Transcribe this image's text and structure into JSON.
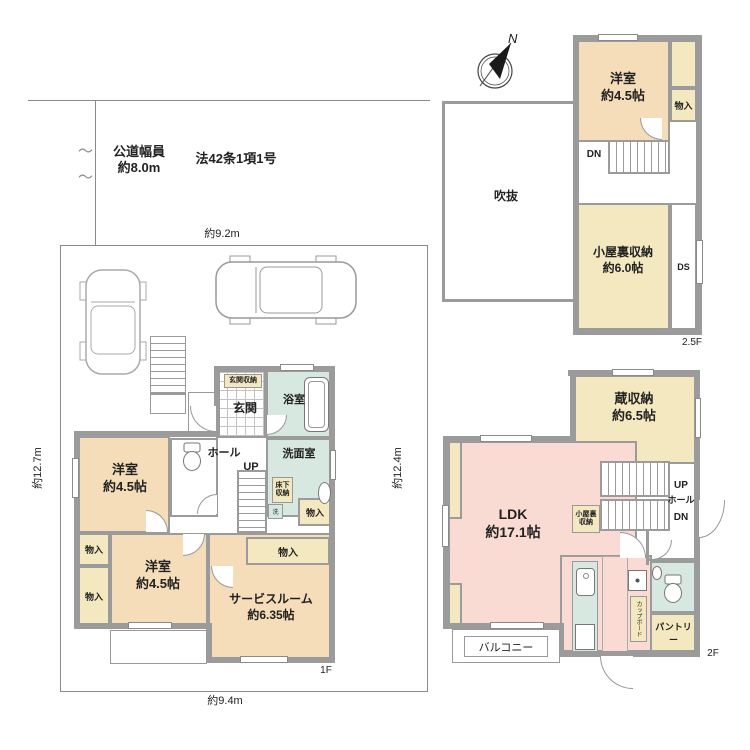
{
  "palette": {
    "wall": "#9b9b9b",
    "line": "#8a8a8a",
    "room_peach": "#f5ddb9",
    "room_yellow": "#f3e8c0",
    "room_pink": "#fadbd3",
    "room_teal": "#d6e8df",
    "text": "#222222",
    "compass_black": "#1a1a1a"
  },
  "site": {
    "road_width_label": "公道幅員",
    "road_width_value": "約8.0m",
    "road_law": "法42条1項1号",
    "dim_top": "約9.2m",
    "dim_bottom": "約9.4m",
    "dim_left": "約12.7m",
    "dim_right": "約12.4m",
    "break_mark": "〜"
  },
  "compass": {
    "north": "N"
  },
  "floor1": {
    "label": "1F",
    "entrance_storage": "玄関収納",
    "entrance": "玄関",
    "bathroom": "浴室",
    "washroom": "洗面室",
    "underfloor_storage": "床下収納",
    "washer": "洗",
    "hall": "ホール",
    "up": "UP",
    "closet": "物入",
    "western_room1": {
      "name": "洋室",
      "size": "約4.5帖"
    },
    "western_room2": {
      "name": "洋室",
      "size": "約4.5帖"
    },
    "service_room": {
      "name": "サービスルーム",
      "size": "約6.35帖"
    }
  },
  "floor2": {
    "label": "2F",
    "kura_storage": {
      "name": "蔵収納",
      "size": "約6.5帖"
    },
    "ldk": {
      "name": "LDK",
      "size": "約17.1帖"
    },
    "attic_storage_small": "小屋裏収納",
    "up": "UP",
    "hall": "ホール",
    "dn": "DN",
    "pantry": "パントリー",
    "cupboard": "カップボード",
    "balcony": "バルコニー"
  },
  "floor2_5": {
    "label": "2.5F",
    "western_room": {
      "name": "洋室",
      "size": "約4.5帖"
    },
    "closet": "物入",
    "dn": "DN",
    "void": "吹抜",
    "attic_storage": {
      "name": "小屋裏収納",
      "size": "約6.0帖"
    },
    "duct_space": "DS"
  }
}
